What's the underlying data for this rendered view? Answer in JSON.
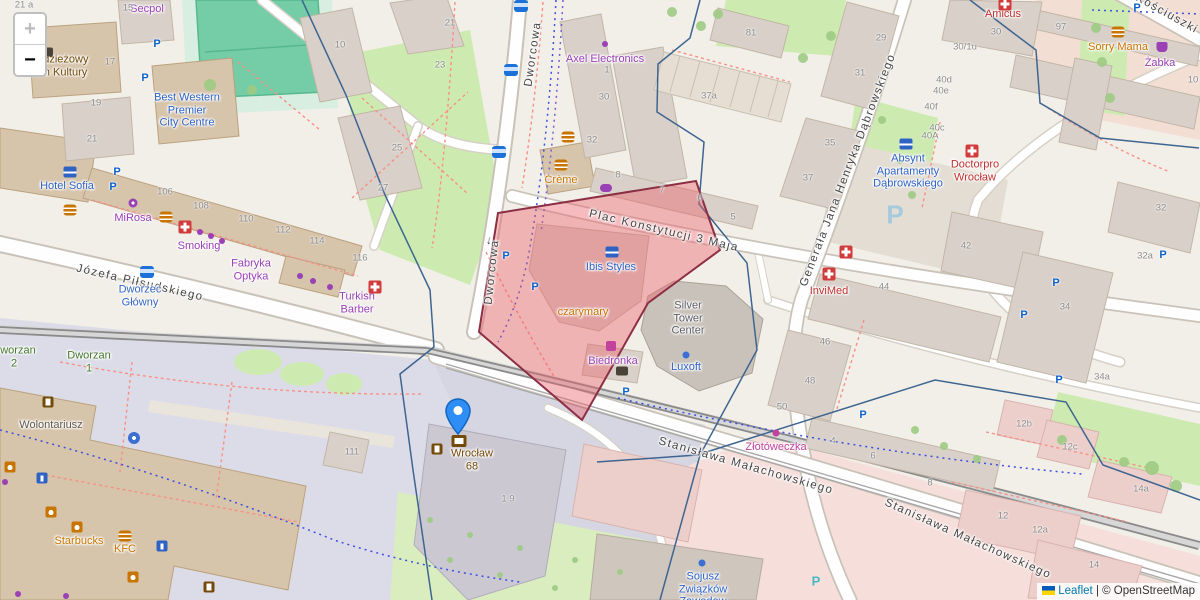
{
  "ui": {
    "zoom_in": "+",
    "zoom_out": "−",
    "attribution": {
      "leaflet": "Leaflet",
      "sep": " | ",
      "osm": "© OpenStreetMap"
    }
  },
  "colors": {
    "shop": "#9a41b5",
    "food": "#c77400",
    "health": "#c03030",
    "hotel": "#2e63c4",
    "office": "#2e63c4",
    "transport": "#3566c0",
    "park": "#46782e",
    "post": "#734a08",
    "pink_shop": "#c2429e",
    "gray": "#5e5e66",
    "social": "#5f584d",
    "street": "#454545",
    "housenum": "#8c8c8c",
    "selection_fill": "#ec5f6a",
    "selection_stroke": "#8c2e44",
    "boundary": "#3e6590",
    "marker_blue": "#2f8ef5"
  },
  "labels": {
    "streets": [
      {
        "t": "Dworcowa",
        "x": 533,
        "y": 54,
        "r": -82
      },
      {
        "t": "Dworcowa",
        "x": 492,
        "y": 272,
        "r": -84
      },
      {
        "t": "←",
        "x": 488,
        "y": 240,
        "r": -84
      },
      {
        "t": "Plac Konstytucji 3 Maja",
        "x": 664,
        "y": 231,
        "r": 13
      },
      {
        "t": "Generała Jana Henryka Dąbrowskiego",
        "x": 848,
        "y": 170,
        "r": -69
      },
      {
        "t": "Józefa Piłsudskiego",
        "x": 140,
        "y": 283,
        "r": 13
      },
      {
        "t": "Stanisława Małachowskiego",
        "x": 746,
        "y": 466,
        "r": 16
      },
      {
        "t": "Stanisława Małachowskiego",
        "x": 968,
        "y": 539,
        "r": 24
      },
      {
        "t": "Kościuszki",
        "x": 1167,
        "y": 14,
        "r": 29
      }
    ],
    "pois": [
      {
        "lines": [
          "Secpol"
        ],
        "x": 147,
        "y": 9,
        "c": "shop"
      },
      {
        "lines": [
          "Młodzieżowy",
          "Dom Kultury"
        ],
        "x": 57,
        "y": 66,
        "c": "post"
      },
      {
        "lines": [
          "Best Western",
          "Premier",
          "City Centre"
        ],
        "x": 187,
        "y": 110,
        "c": "hotel"
      },
      {
        "lines": [
          "Hotel Sofia"
        ],
        "x": 67,
        "y": 186,
        "c": "hotel"
      },
      {
        "lines": [
          "MiRosa"
        ],
        "x": 133,
        "y": 218,
        "c": "shop"
      },
      {
        "lines": [
          "Smoking"
        ],
        "x": 199,
        "y": 246,
        "c": "shop"
      },
      {
        "lines": [
          "Fabryka",
          "Optyka"
        ],
        "x": 251,
        "y": 270,
        "c": "shop"
      },
      {
        "lines": [
          "Turkish",
          "Barber"
        ],
        "x": 357,
        "y": 303,
        "c": "shop"
      },
      {
        "lines": [
          "Dworzec",
          "Główny"
        ],
        "x": 140,
        "y": 296,
        "c": "transport"
      },
      {
        "lines": [
          "Dworzan",
          "2"
        ],
        "x": 14,
        "y": 357,
        "c": "park"
      },
      {
        "lines": [
          "Dworzan",
          "1"
        ],
        "x": 89,
        "y": 362,
        "c": "park"
      },
      {
        "lines": [
          "Wolontariusz"
        ],
        "x": 51,
        "y": 425,
        "c": "social"
      },
      {
        "lines": [
          "Starbucks"
        ],
        "x": 79,
        "y": 541,
        "c": "food"
      },
      {
        "lines": [
          "KFC"
        ],
        "x": 125,
        "y": 549,
        "c": "food"
      },
      {
        "lines": [
          "Axel Electronics"
        ],
        "x": 605,
        "y": 59,
        "c": "shop"
      },
      {
        "lines": [
          "Crème"
        ],
        "x": 561,
        "y": 180,
        "c": "food"
      },
      {
        "lines": [
          "Ibis Styles"
        ],
        "x": 611,
        "y": 267,
        "c": "hotel"
      },
      {
        "lines": [
          "czarymary"
        ],
        "x": 583,
        "y": 312,
        "c": "food"
      },
      {
        "lines": [
          "Biedronka"
        ],
        "x": 613,
        "y": 361,
        "c": "shop"
      },
      {
        "lines": [
          "Silver",
          "Tower",
          "Center"
        ],
        "x": 688,
        "y": 318,
        "c": "gray"
      },
      {
        "lines": [
          "Luxoft"
        ],
        "x": 686,
        "y": 367,
        "c": "office"
      },
      {
        "lines": [
          "InviMed"
        ],
        "x": 829,
        "y": 291,
        "c": "health"
      },
      {
        "lines": [
          "Absynt",
          "Apartamenty",
          "Dąbrowskiego"
        ],
        "x": 908,
        "y": 171,
        "c": "hotel"
      },
      {
        "lines": [
          "Doctorpro",
          "Wrocław"
        ],
        "x": 975,
        "y": 171,
        "c": "health"
      },
      {
        "lines": [
          "Amicus"
        ],
        "x": 1003,
        "y": 14,
        "c": "health"
      },
      {
        "lines": [
          "Sorry Mama"
        ],
        "x": 1118,
        "y": 47,
        "c": "food"
      },
      {
        "lines": [
          "Żabka"
        ],
        "x": 1160,
        "y": 63,
        "c": "shop"
      },
      {
        "lines": [
          "Złotóweczka"
        ],
        "x": 776,
        "y": 447,
        "c": "pink_shop"
      },
      {
        "lines": [
          "Sojusz",
          "Związków",
          "Zawodow"
        ],
        "x": 703,
        "y": 589,
        "c": "hotel"
      },
      {
        "lines": [
          "Wrocław",
          "68"
        ],
        "x": 472,
        "y": 460,
        "c": "post"
      }
    ],
    "house_numbers": [
      {
        "t": "21 a",
        "x": 24,
        "y": 5
      },
      {
        "t": "15",
        "x": 128,
        "y": 8
      },
      {
        "t": "17",
        "x": 110,
        "y": 62
      },
      {
        "t": "19",
        "x": 96,
        "y": 103
      },
      {
        "t": "21",
        "x": 92,
        "y": 139
      },
      {
        "t": "10",
        "x": 340,
        "y": 45
      },
      {
        "t": "21",
        "x": 450,
        "y": 23
      },
      {
        "t": "23",
        "x": 440,
        "y": 65
      },
      {
        "t": "25",
        "x": 397,
        "y": 148
      },
      {
        "t": "27",
        "x": 383,
        "y": 188
      },
      {
        "t": "30",
        "x": 604,
        "y": 97
      },
      {
        "t": "32",
        "x": 592,
        "y": 140
      },
      {
        "t": "8",
        "x": 618,
        "y": 175
      },
      {
        "t": "1",
        "x": 607,
        "y": 70
      },
      {
        "t": "7",
        "x": 662,
        "y": 190
      },
      {
        "t": "6",
        "x": 700,
        "y": 198
      },
      {
        "t": "5",
        "x": 733,
        "y": 217
      },
      {
        "t": "81",
        "x": 751,
        "y": 33
      },
      {
        "t": "37a",
        "x": 709,
        "y": 96
      },
      {
        "t": "29",
        "x": 881,
        "y": 38
      },
      {
        "t": "31",
        "x": 860,
        "y": 73
      },
      {
        "t": "35",
        "x": 830,
        "y": 143
      },
      {
        "t": "37",
        "x": 808,
        "y": 178
      },
      {
        "t": "97",
        "x": 1061,
        "y": 27
      },
      {
        "t": "30",
        "x": 996,
        "y": 32
      },
      {
        "t": "30/1u",
        "x": 965,
        "y": 47
      },
      {
        "t": "10",
        "x": 1193,
        "y": 80
      },
      {
        "t": "40d",
        "x": 944,
        "y": 80
      },
      {
        "t": "40e",
        "x": 941,
        "y": 91
      },
      {
        "t": "40f",
        "x": 931,
        "y": 107
      },
      {
        "t": "40c",
        "x": 937,
        "y": 128
      },
      {
        "t": "40A",
        "x": 930,
        "y": 136
      },
      {
        "t": "42",
        "x": 966,
        "y": 246
      },
      {
        "t": "44",
        "x": 884,
        "y": 287
      },
      {
        "t": "46",
        "x": 825,
        "y": 342
      },
      {
        "t": "48",
        "x": 810,
        "y": 381
      },
      {
        "t": "50",
        "x": 782,
        "y": 407
      },
      {
        "t": "32",
        "x": 1161,
        "y": 208
      },
      {
        "t": "32a",
        "x": 1145,
        "y": 256
      },
      {
        "t": "34",
        "x": 1065,
        "y": 307
      },
      {
        "t": "34a",
        "x": 1102,
        "y": 377
      },
      {
        "t": "12b",
        "x": 1024,
        "y": 424
      },
      {
        "t": "12c",
        "x": 1070,
        "y": 447
      },
      {
        "t": "14a",
        "x": 1141,
        "y": 489
      },
      {
        "t": "12",
        "x": 1003,
        "y": 516
      },
      {
        "t": "12a",
        "x": 1040,
        "y": 530
      },
      {
        "t": "14",
        "x": 1094,
        "y": 565
      },
      {
        "t": "4",
        "x": 833,
        "y": 441
      },
      {
        "t": "6",
        "x": 873,
        "y": 456
      },
      {
        "t": "8",
        "x": 930,
        "y": 483
      },
      {
        "t": "106",
        "x": 165,
        "y": 192
      },
      {
        "t": "108",
        "x": 201,
        "y": 206
      },
      {
        "t": "110",
        "x": 246,
        "y": 219
      },
      {
        "t": "112",
        "x": 283,
        "y": 230
      },
      {
        "t": "114",
        "x": 317,
        "y": 241
      },
      {
        "t": "116",
        "x": 360,
        "y": 258
      },
      {
        "t": "111",
        "x": 352,
        "y": 452
      },
      {
        "t": "1 9",
        "x": 508,
        "y": 499
      }
    ],
    "icons": [
      {
        "k": "p",
        "x": 157,
        "y": 44
      },
      {
        "k": "p",
        "x": 145,
        "y": 78
      },
      {
        "k": "p",
        "x": 117,
        "y": 172
      },
      {
        "k": "p",
        "x": 113,
        "y": 187
      },
      {
        "k": "p",
        "x": 506,
        "y": 256
      },
      {
        "k": "p",
        "x": 1137,
        "y": 8
      },
      {
        "k": "p",
        "x": 863,
        "y": 415
      },
      {
        "k": "p",
        "x": 1024,
        "y": 315
      },
      {
        "k": "pb",
        "x": 535,
        "y": 287
      },
      {
        "k": "pb",
        "x": 626,
        "y": 392
      },
      {
        "k": "pb",
        "x": 1056,
        "y": 283
      },
      {
        "k": "pb",
        "x": 1163,
        "y": 255
      },
      {
        "k": "pb",
        "x": 1059,
        "y": 380
      },
      {
        "k": "pbig",
        "x": 895,
        "y": 215
      },
      {
        "k": "plight",
        "x": 816,
        "y": 581
      },
      {
        "k": "bus",
        "x": 521,
        "y": 6
      },
      {
        "k": "bus",
        "x": 511,
        "y": 70
      },
      {
        "k": "bus",
        "x": 499,
        "y": 152
      },
      {
        "k": "bus",
        "x": 147,
        "y": 272
      },
      {
        "k": "burger",
        "x": 568,
        "y": 137
      },
      {
        "k": "burger",
        "x": 561,
        "y": 165
      },
      {
        "k": "burger",
        "x": 70,
        "y": 210
      },
      {
        "k": "burger",
        "x": 166,
        "y": 217
      },
      {
        "k": "burger",
        "x": 125,
        "y": 536
      },
      {
        "k": "burger",
        "x": 1118,
        "y": 32
      },
      {
        "k": "coffee",
        "x": 51,
        "y": 512
      },
      {
        "k": "coffee",
        "x": 77,
        "y": 527
      },
      {
        "k": "coffee",
        "x": 133,
        "y": 577
      },
      {
        "k": "coffee",
        "x": 10,
        "y": 467
      },
      {
        "k": "cross",
        "x": 846,
        "y": 252
      },
      {
        "k": "cross",
        "x": 829,
        "y": 274
      },
      {
        "k": "cross",
        "x": 972,
        "y": 151
      },
      {
        "k": "cross",
        "x": 1005,
        "y": 4
      },
      {
        "k": "cross",
        "x": 185,
        "y": 227
      },
      {
        "k": "cross",
        "x": 375,
        "y": 287
      },
      {
        "k": "flower",
        "x": 133,
        "y": 203
      },
      {
        "k": "basket",
        "x": 1162,
        "y": 47
      },
      {
        "k": "cart",
        "x": 611,
        "y": 346
      },
      {
        "k": "dotp",
        "x": 605,
        "y": 44
      },
      {
        "k": "dotp",
        "x": 200,
        "y": 232
      },
      {
        "k": "dotp",
        "x": 211,
        "y": 236
      },
      {
        "k": "dotp",
        "x": 222,
        "y": 241
      },
      {
        "k": "dotp",
        "x": 300,
        "y": 276
      },
      {
        "k": "dotp",
        "x": 313,
        "y": 281
      },
      {
        "k": "dotp",
        "x": 330,
        "y": 287
      },
      {
        "k": "dotp",
        "x": 5,
        "y": 482
      },
      {
        "k": "dotp",
        "x": 18,
        "y": 594
      },
      {
        "k": "dotp",
        "x": 66,
        "y": 596
      },
      {
        "k": "dotm",
        "x": 776,
        "y": 433
      },
      {
        "k": "dotb",
        "x": 686,
        "y": 355
      },
      {
        "k": "dotb",
        "x": 702,
        "y": 563
      },
      {
        "k": "bed",
        "x": 612,
        "y": 252
      },
      {
        "k": "bed",
        "x": 906,
        "y": 144
      },
      {
        "k": "bed",
        "x": 70,
        "y": 172
      },
      {
        "k": "env",
        "x": 459,
        "y": 441
      },
      {
        "k": "lugg",
        "x": 437,
        "y": 449
      },
      {
        "k": "lugg",
        "x": 48,
        "y": 402
      },
      {
        "k": "lugg",
        "x": 209,
        "y": 587
      },
      {
        "k": "fountain",
        "x": 134,
        "y": 438
      },
      {
        "k": "info",
        "x": 42,
        "y": 478
      },
      {
        "k": "info",
        "x": 162,
        "y": 546
      },
      {
        "k": "bike",
        "x": 606,
        "y": 188
      },
      {
        "k": "dark",
        "x": 622,
        "y": 371
      },
      {
        "k": "dark",
        "x": 47,
        "y": 52
      }
    ]
  },
  "marker": {
    "title": "Wrocław 68"
  }
}
